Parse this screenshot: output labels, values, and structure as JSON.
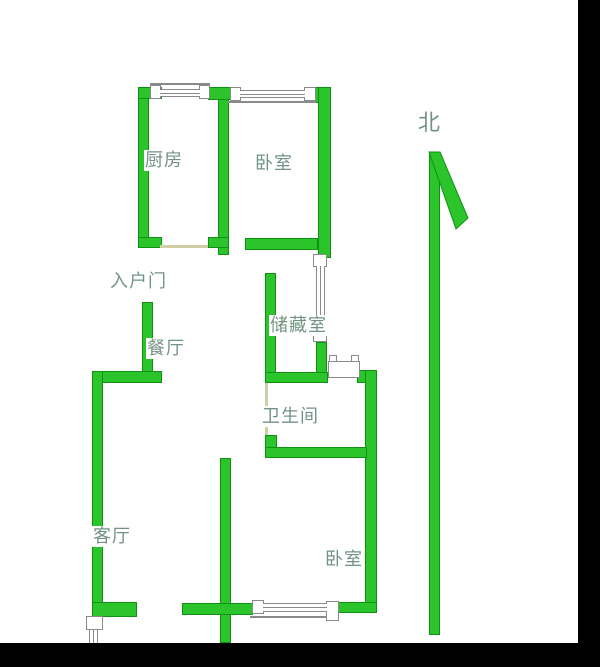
{
  "page": {
    "description": "Apartment floor plan drawing with green walls on white background, black matte bars on right and bottom edges"
  },
  "colors": {
    "wall_fill": "#2bc52b",
    "wall_border": "#0f9212",
    "label_text": "#729384",
    "door_line": "#cfcfa6",
    "frame_border": "#8a8a8a",
    "background": "#ffffff",
    "matte": "#000000"
  },
  "floorplan": {
    "labels": [
      {
        "name": "kitchen-label",
        "text": "厨房",
        "x": 144,
        "y": 150,
        "large": false
      },
      {
        "name": "bedroom1-label",
        "text": "卧室",
        "x": 254,
        "y": 153,
        "large": false
      },
      {
        "name": "north-label",
        "text": "北",
        "x": 417,
        "y": 110,
        "large": true
      },
      {
        "name": "entry-door-label",
        "text": "入户门",
        "x": 109,
        "y": 271,
        "large": false
      },
      {
        "name": "storage-label",
        "text": "储藏室",
        "x": 269,
        "y": 315,
        "large": false
      },
      {
        "name": "dining-label",
        "text": "餐厅",
        "x": 146,
        "y": 338,
        "large": false
      },
      {
        "name": "bathroom-label",
        "text": "卫生间",
        "x": 261,
        "y": 406,
        "large": false
      },
      {
        "name": "living-label",
        "text": "客厅",
        "x": 92,
        "y": 526,
        "large": false
      },
      {
        "name": "bedroom2-label",
        "text": "卧室",
        "x": 324,
        "y": 549,
        "large": false
      }
    ],
    "north_arrow": {
      "name": "north-arrowhead",
      "points": "429,152 440,152 468,218 456,229"
    },
    "elements": [
      {
        "type": "black",
        "name": "right-black-bar",
        "x": 578,
        "y": 0,
        "w": 22,
        "h": 667
      },
      {
        "type": "black",
        "name": "bottom-black-bar",
        "x": 0,
        "y": 643,
        "w": 600,
        "h": 24
      },
      {
        "type": "wall",
        "name": "kitchen-left-wall",
        "x": 138,
        "y": 87,
        "w": 11,
        "h": 161
      },
      {
        "type": "wall",
        "name": "kitchen-top-left-wall",
        "x": 138,
        "y": 87,
        "w": 24,
        "h": 12
      },
      {
        "type": "wall",
        "name": "kitchen-bottom-left-foot",
        "x": 138,
        "y": 237,
        "w": 24,
        "h": 11
      },
      {
        "type": "wall",
        "name": "kitchen-bedroom-divider-wall",
        "x": 218,
        "y": 87,
        "w": 11,
        "h": 168
      },
      {
        "type": "wall",
        "name": "kitchen-top-right-wall",
        "x": 208,
        "y": 87,
        "w": 26,
        "h": 13
      },
      {
        "type": "wall",
        "name": "kitchen-bottom-right-foot",
        "x": 208,
        "y": 237,
        "w": 21,
        "h": 11
      },
      {
        "type": "wall",
        "name": "bedroom1-top-right-corner",
        "x": 311,
        "y": 87,
        "w": 20,
        "h": 16
      },
      {
        "type": "wall",
        "name": "bedroom1-right-wall",
        "x": 318,
        "y": 87,
        "w": 13,
        "h": 171
      },
      {
        "type": "wall",
        "name": "bedroom1-bottom-wall",
        "x": 245,
        "y": 238,
        "w": 73,
        "h": 12
      },
      {
        "type": "wall",
        "name": "storage-left-wall",
        "x": 265,
        "y": 273,
        "w": 11,
        "h": 110
      },
      {
        "type": "wall",
        "name": "storage-right-wall-lower",
        "x": 316,
        "y": 342,
        "w": 11,
        "h": 32
      },
      {
        "type": "wall",
        "name": "bathroom-top-wall",
        "x": 265,
        "y": 372,
        "w": 63,
        "h": 11
      },
      {
        "type": "wall",
        "name": "bathroom-top-right-corner",
        "x": 357,
        "y": 370,
        "w": 20,
        "h": 13
      },
      {
        "type": "wall",
        "name": "bathroom-bedroom2-right-wall",
        "x": 365,
        "y": 370,
        "w": 12,
        "h": 243
      },
      {
        "type": "wall",
        "name": "bathroom-bottom-left-nub",
        "x": 265,
        "y": 435,
        "w": 12,
        "h": 14
      },
      {
        "type": "wall",
        "name": "bathroom-bottom-wall",
        "x": 265,
        "y": 447,
        "w": 102,
        "h": 11
      },
      {
        "type": "wall",
        "name": "entry-wall",
        "x": 142,
        "y": 302,
        "w": 11,
        "h": 70
      },
      {
        "type": "wall",
        "name": "dining-top-wall",
        "x": 92,
        "y": 371,
        "w": 70,
        "h": 12
      },
      {
        "type": "wall",
        "name": "living-left-wall",
        "x": 92,
        "y": 371,
        "w": 11,
        "h": 252
      },
      {
        "type": "wall",
        "name": "living-bottom-foot",
        "x": 92,
        "y": 602,
        "w": 45,
        "h": 15
      },
      {
        "type": "wall",
        "name": "living-bedroom-divider-wall",
        "x": 220,
        "y": 458,
        "w": 11,
        "h": 185
      },
      {
        "type": "wall",
        "name": "living-bottom-wall",
        "x": 182,
        "y": 603,
        "w": 71,
        "h": 12
      },
      {
        "type": "wall",
        "name": "bedroom2-bottom-wall",
        "x": 328,
        "y": 602,
        "w": 49,
        "h": 11
      },
      {
        "type": "wall",
        "name": "north-arrow-line",
        "x": 429,
        "y": 152,
        "w": 11,
        "h": 483
      },
      {
        "type": "thin",
        "name": "kitchen-door-line",
        "x": 160,
        "y": 245,
        "w": 48,
        "h": 3
      },
      {
        "type": "thin",
        "name": "bathroom-door-line",
        "x": 265,
        "y": 383,
        "w": 3,
        "h": 52
      },
      {
        "type": "line",
        "name": "kitchen-window-outer-line",
        "x": 150,
        "y": 83,
        "w": 60,
        "h": 2
      },
      {
        "type": "line",
        "name": "bedroom1-window-outer-line",
        "x": 228,
        "y": 101,
        "w": 88,
        "h": 2
      },
      {
        "type": "line",
        "name": "bedroom2-window-outer-line",
        "x": 250,
        "y": 616,
        "w": 87,
        "h": 2
      },
      {
        "type": "frame",
        "name": "kitchen-window-tab-left",
        "x": 150,
        "y": 85,
        "w": 11,
        "h": 14
      },
      {
        "type": "frame",
        "name": "kitchen-window-tab-right",
        "x": 199,
        "y": 85,
        "w": 11,
        "h": 14
      },
      {
        "type": "frame",
        "name": "bedroom1-window-tab-left",
        "x": 230,
        "y": 87,
        "w": 11,
        "h": 14
      },
      {
        "type": "frame",
        "name": "bedroom1-window-tab-right",
        "x": 304,
        "y": 87,
        "w": 12,
        "h": 14
      },
      {
        "type": "frame",
        "name": "storage-window-tab-top",
        "x": 313,
        "y": 254,
        "w": 14,
        "h": 13
      },
      {
        "type": "frame",
        "name": "storage-window-tab-bottom",
        "x": 313,
        "y": 329,
        "w": 14,
        "h": 13
      },
      {
        "type": "frame",
        "name": "bathroom-door-tab-left",
        "x": 329,
        "y": 355,
        "w": 8,
        "h": 8
      },
      {
        "type": "frame",
        "name": "bathroom-door-tab-right",
        "x": 351,
        "y": 355,
        "w": 8,
        "h": 8
      },
      {
        "type": "frame",
        "name": "bathroom-door-frame",
        "x": 328,
        "y": 361,
        "w": 32,
        "h": 17
      },
      {
        "type": "frame",
        "name": "bedroom2-window-tab-left",
        "x": 252,
        "y": 600,
        "w": 12,
        "h": 14
      },
      {
        "type": "frame",
        "name": "bedroom2-window-tab-right",
        "x": 326,
        "y": 601,
        "w": 13,
        "h": 20
      },
      {
        "type": "frame",
        "name": "entry-door-frame",
        "x": 86,
        "y": 616,
        "w": 17,
        "h": 14
      },
      {
        "type": "glass-h",
        "name": "kitchen-window-glass",
        "x": 160,
        "y": 89,
        "w": 40,
        "h": 8
      },
      {
        "type": "glass-h",
        "name": "bedroom1-window-glass",
        "x": 240,
        "y": 90,
        "w": 65,
        "h": 8
      },
      {
        "type": "glass-v",
        "name": "storage-window-glass",
        "x": 316,
        "y": 266,
        "w": 9,
        "h": 64
      },
      {
        "type": "glass-h",
        "name": "bedroom2-window-glass",
        "x": 263,
        "y": 603,
        "w": 64,
        "h": 9
      },
      {
        "type": "glass-v",
        "name": "entry-door-glass",
        "x": 89,
        "y": 630,
        "w": 9,
        "h": 13
      }
    ]
  }
}
